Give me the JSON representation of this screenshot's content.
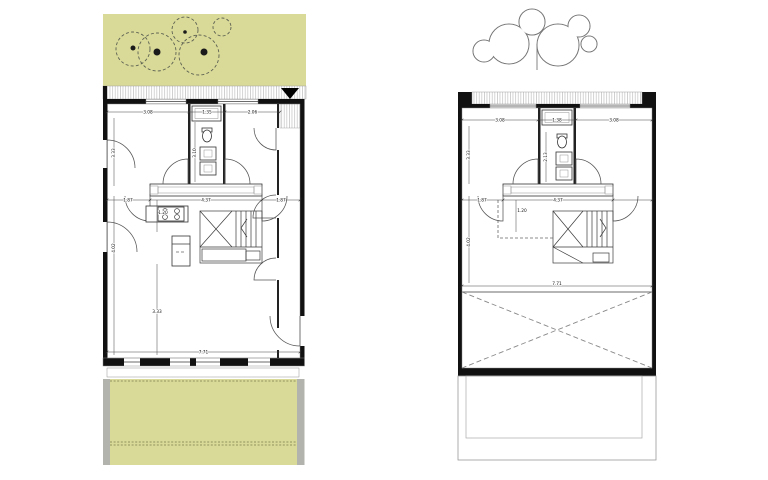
{
  "colors": {
    "garden_green": "#d9da98",
    "wall_black": "#111111",
    "retaining_gray": "#b3b3ae",
    "background": "#ffffff"
  },
  "left_plan": {
    "label": "ground-floor-plan",
    "dims": {
      "top_left": "3.08",
      "top_mid": "1.35",
      "top_right": "2.06",
      "room_height": "3.33",
      "core_height": "3.10",
      "mid_left": "1.87",
      "mid_center": "4.37",
      "mid_right": "1.87",
      "mid_depth": "1.20",
      "lower_height": "4.02",
      "living_height": "3.33",
      "total_width": "7.71"
    }
  },
  "right_plan": {
    "label": "upper-floor-plan",
    "dims": {
      "top_left": "3.08",
      "top_mid": "1.38",
      "top_right": "3.08",
      "room_height": "3.33",
      "core_height": "2.13",
      "mid_left": "1.87",
      "mid_center": "4.37",
      "mid_depth": "1.20",
      "lower_height": "4.02",
      "total_width": "7.71"
    }
  }
}
